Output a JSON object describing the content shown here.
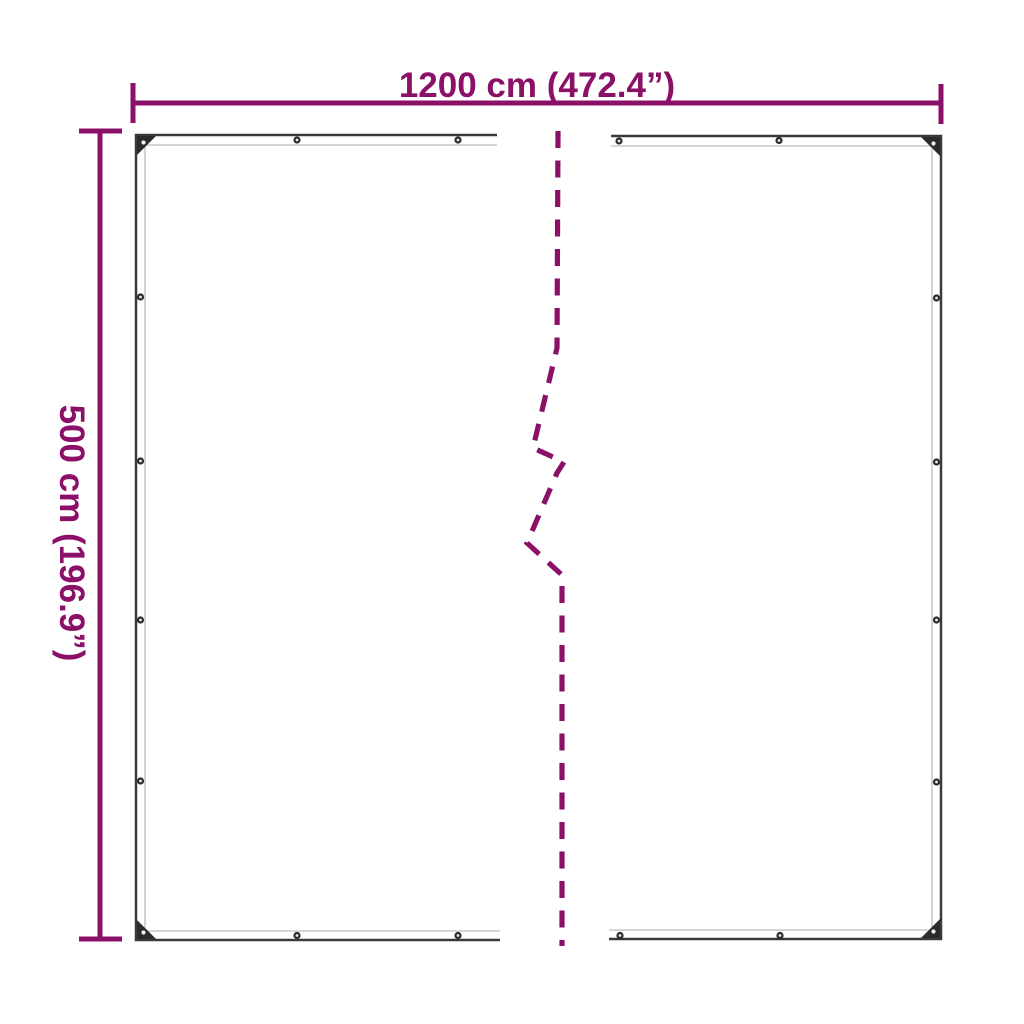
{
  "diagram": {
    "type": "product-dimension-diagram",
    "top_dimension": {
      "label": "1200 cm (472.4”)"
    },
    "left_dimension": {
      "label": "500 cm (196.9”)"
    },
    "colors": {
      "dimension_accent": "#8B1068",
      "tarp_outline": "#3a3a3a",
      "tarp_inner_seam": "#c8c8c8",
      "eyelet_dark": "#2b2b2b",
      "background": "#ffffff"
    },
    "eyelets": {
      "top_edge_count": 4,
      "bottom_edge_count": 4,
      "left_edge_count": 4,
      "right_edge_count": 4,
      "corner_count": 4
    }
  }
}
